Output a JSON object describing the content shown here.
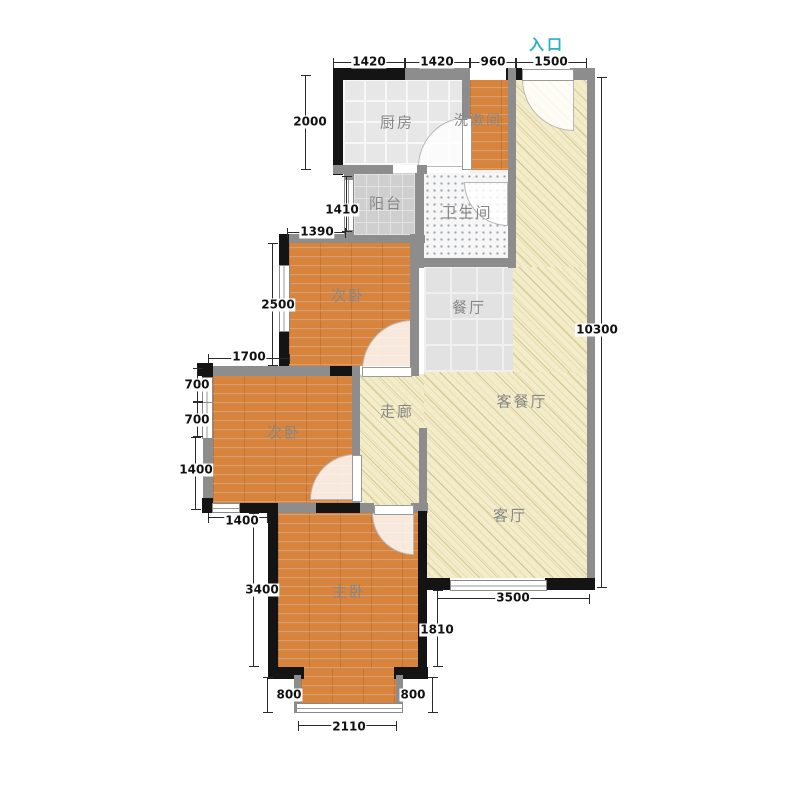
{
  "title": "三室户型平面图",
  "entrance": {
    "label": "入口"
  },
  "rooms": {
    "kitchen": "厨房",
    "washroom": "洗漱间",
    "balcony": "阳台",
    "bathroom": "卫生间",
    "dining": "餐厅",
    "bedroom_upper": "次卧",
    "bedroom_lower": "次卧",
    "corridor": "走廊",
    "living_dining": "客餐厅",
    "living": "客厅",
    "master": "主卧"
  },
  "dims": {
    "top": [
      "1420",
      "1420",
      "960",
      "1500"
    ],
    "kitchen_left": "2000",
    "balcony_left": "1410",
    "bedroom_upper_top": "1390",
    "bedroom_upper_left": "2500",
    "bedroom_lower_top": "1700",
    "bedroom_lower_left": [
      "700",
      "700",
      "1400"
    ],
    "bedroom_lower_bottom": "1400",
    "master_left": "3400",
    "bay_left": "800",
    "bay_right": "800",
    "bay_width": "2110",
    "master_right": "1810",
    "living_bottom": "3500",
    "right_total": "10300"
  },
  "colors": {
    "wall_gray": "#8d8d8d",
    "wall_black": "#141414",
    "wood_floor": "#d9843c",
    "living_hatch": "#f3ecc9",
    "tile_gray": "#e7e7e7",
    "entrance_accent": "#27b2c4",
    "label_gray": "#878787"
  }
}
